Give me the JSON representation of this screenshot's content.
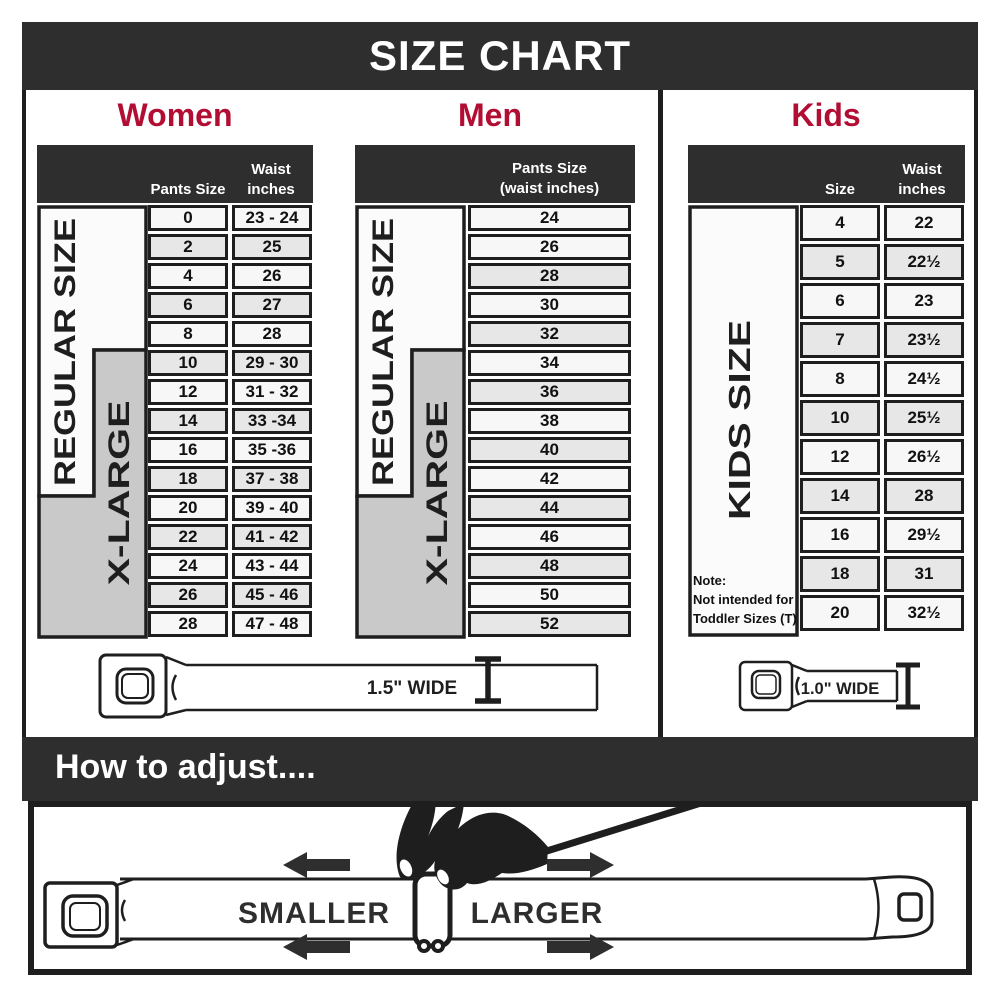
{
  "title": "SIZE CHART",
  "colors": {
    "banner": "#2e2e2e",
    "accent": "#b20d33",
    "row_shaded": "#e7e7e7",
    "band_gray": "#c9c9c9",
    "line": "#1e1e1e"
  },
  "women": {
    "heading": "Women",
    "header": {
      "col1": "Pants Size",
      "col2a": "Waist",
      "col2b": "inches"
    },
    "bands": {
      "regular": "REGULAR SIZE",
      "xlarge": "X-LARGE"
    },
    "rows": [
      [
        "0",
        "23 - 24"
      ],
      [
        "2",
        "25"
      ],
      [
        "4",
        "26"
      ],
      [
        "6",
        "27"
      ],
      [
        "8",
        "28"
      ],
      [
        "10",
        "29 - 30"
      ],
      [
        "12",
        "31 - 32"
      ],
      [
        "14",
        "33 -34"
      ],
      [
        "16",
        "35 -36"
      ],
      [
        "18",
        "37 - 38"
      ],
      [
        "20",
        "39 - 40"
      ],
      [
        "22",
        "41 - 42"
      ],
      [
        "24",
        "43 - 44"
      ],
      [
        "26",
        "45 - 46"
      ],
      [
        "28",
        "47 - 48"
      ]
    ],
    "shaded": [
      false,
      true,
      false,
      true,
      false,
      true,
      false,
      true,
      false,
      true,
      false,
      true,
      false,
      true,
      false
    ]
  },
  "men": {
    "heading": "Men",
    "header": {
      "col2a": "Pants Size",
      "col2b": "(waist inches)"
    },
    "bands": {
      "regular": "REGULAR SIZE",
      "xlarge": "X-LARGE"
    },
    "rows": [
      [
        "24"
      ],
      [
        "26"
      ],
      [
        "28"
      ],
      [
        "30"
      ],
      [
        "32"
      ],
      [
        "34"
      ],
      [
        "36"
      ],
      [
        "38"
      ],
      [
        "40"
      ],
      [
        "42"
      ],
      [
        "44"
      ],
      [
        "46"
      ],
      [
        "48"
      ],
      [
        "50"
      ],
      [
        "52"
      ]
    ],
    "shaded": [
      false,
      false,
      true,
      false,
      true,
      false,
      true,
      false,
      true,
      false,
      true,
      false,
      true,
      false,
      true
    ]
  },
  "kids": {
    "heading": "Kids",
    "header": {
      "col1": "Size",
      "col2a": "Waist",
      "col2b": "inches"
    },
    "bands": {
      "kids": "KIDS SIZE"
    },
    "note": [
      "Note:",
      "Not intended for",
      "Toddler Sizes (T)"
    ],
    "rows": [
      [
        "4",
        "22"
      ],
      [
        "5",
        "22½"
      ],
      [
        "6",
        "23"
      ],
      [
        "7",
        "23½"
      ],
      [
        "8",
        "24½"
      ],
      [
        "10",
        "25½"
      ],
      [
        "12",
        "26½"
      ],
      [
        "14",
        "28"
      ],
      [
        "16",
        "29½"
      ],
      [
        "18",
        "31"
      ],
      [
        "20",
        "32½"
      ]
    ],
    "shaded": [
      false,
      true,
      false,
      true,
      false,
      true,
      false,
      true,
      false,
      true,
      false
    ]
  },
  "belts": {
    "adult_label": "1.5\" WIDE",
    "kids_label": "1.0\" WIDE"
  },
  "adjust": {
    "heading": "How to adjust....",
    "smaller": "SMALLER",
    "larger": "LARGER"
  },
  "chart_data": [
    {
      "type": "table",
      "title": "Women",
      "columns": [
        "Pants Size",
        "Waist inches"
      ],
      "rows": [
        [
          "0",
          "23 - 24"
        ],
        [
          "2",
          "25"
        ],
        [
          "4",
          "26"
        ],
        [
          "6",
          "27"
        ],
        [
          "8",
          "28"
        ],
        [
          "10",
          "29 - 30"
        ],
        [
          "12",
          "31 - 32"
        ],
        [
          "14",
          "33 -34"
        ],
        [
          "16",
          "35 -36"
        ],
        [
          "18",
          "37 - 38"
        ],
        [
          "20",
          "39 - 40"
        ],
        [
          "22",
          "41 - 42"
        ],
        [
          "24",
          "43 - 44"
        ],
        [
          "26",
          "45 - 46"
        ],
        [
          "28",
          "47 - 48"
        ]
      ],
      "groups": {
        "REGULAR SIZE": "pants 0-18",
        "X-LARGE": "pants 10-28"
      },
      "belt_width": "1.5\" WIDE"
    },
    {
      "type": "table",
      "title": "Men",
      "columns": [
        "Pants Size (waist inches)"
      ],
      "rows": [
        [
          "24"
        ],
        [
          "26"
        ],
        [
          "28"
        ],
        [
          "30"
        ],
        [
          "32"
        ],
        [
          "34"
        ],
        [
          "36"
        ],
        [
          "38"
        ],
        [
          "40"
        ],
        [
          "42"
        ],
        [
          "44"
        ],
        [
          "46"
        ],
        [
          "48"
        ],
        [
          "50"
        ],
        [
          "52"
        ]
      ],
      "groups": {
        "REGULAR SIZE": "pants 24-42",
        "X-LARGE": "pants 34-52"
      },
      "belt_width": "1.5\" WIDE"
    },
    {
      "type": "table",
      "title": "Kids",
      "columns": [
        "Size",
        "Waist inches"
      ],
      "rows": [
        [
          "4",
          "22"
        ],
        [
          "5",
          "22½"
        ],
        [
          "6",
          "23"
        ],
        [
          "7",
          "23½"
        ],
        [
          "8",
          "24½"
        ],
        [
          "10",
          "25½"
        ],
        [
          "12",
          "26½"
        ],
        [
          "14",
          "28"
        ],
        [
          "16",
          "29½"
        ],
        [
          "18",
          "31"
        ],
        [
          "20",
          "32½"
        ]
      ],
      "groups": {
        "KIDS SIZE": "sizes 4-20"
      },
      "note": "Note: Not intended for Toddler Sizes (T)",
      "belt_width": "1.0\" WIDE"
    }
  ]
}
